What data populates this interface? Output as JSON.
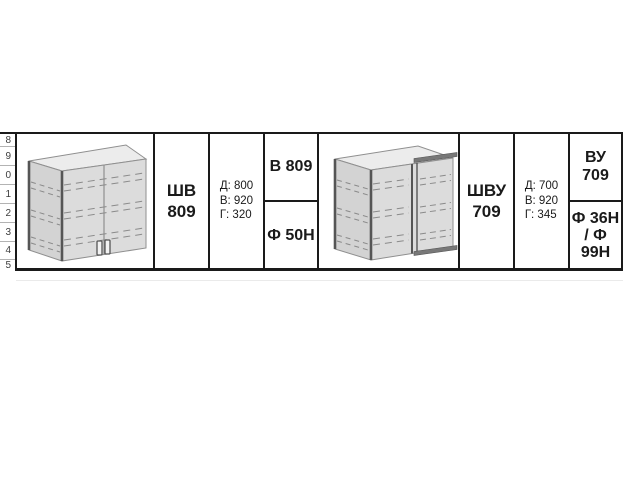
{
  "page": {
    "background": "#ffffff"
  },
  "row_index_column": {
    "items": [
      "8",
      "9",
      "0",
      "1",
      "2",
      "3",
      "4",
      "5"
    ]
  },
  "products": [
    {
      "model": "ШВ 809",
      "name_lines": [
        "ШВ",
        "809"
      ],
      "dimensions": [
        "Д: 800",
        "В: 920",
        "Г: 320"
      ],
      "facade_top": "В 809",
      "facade_bottom_lines": [
        "Ф 50Н"
      ],
      "drawing": "two-door-wall-cabinet"
    },
    {
      "model": "ШВУ 709",
      "name_lines": [
        "ШВУ",
        "709"
      ],
      "dimensions": [
        "Д: 700",
        "В: 920",
        "Г: 345"
      ],
      "facade_top": "ВУ 709",
      "facade_bottom_lines": [
        "Ф 36Н",
        "/ Ф",
        "99Н"
      ],
      "drawing": "corner-wall-cabinet"
    }
  ],
  "colors": {
    "table_border": "#1a1a1a",
    "index_separator": "#b3b3b3",
    "cabinet_front_fill": "#dcdcdc",
    "cabinet_top_fill": "#ececec",
    "cabinet_side_fill": "#d3d3d3",
    "cabinet_cap_fill": "#787878",
    "cabinet_outline": "#8f8f8f",
    "cabinet_dark_edge": "#555555"
  }
}
